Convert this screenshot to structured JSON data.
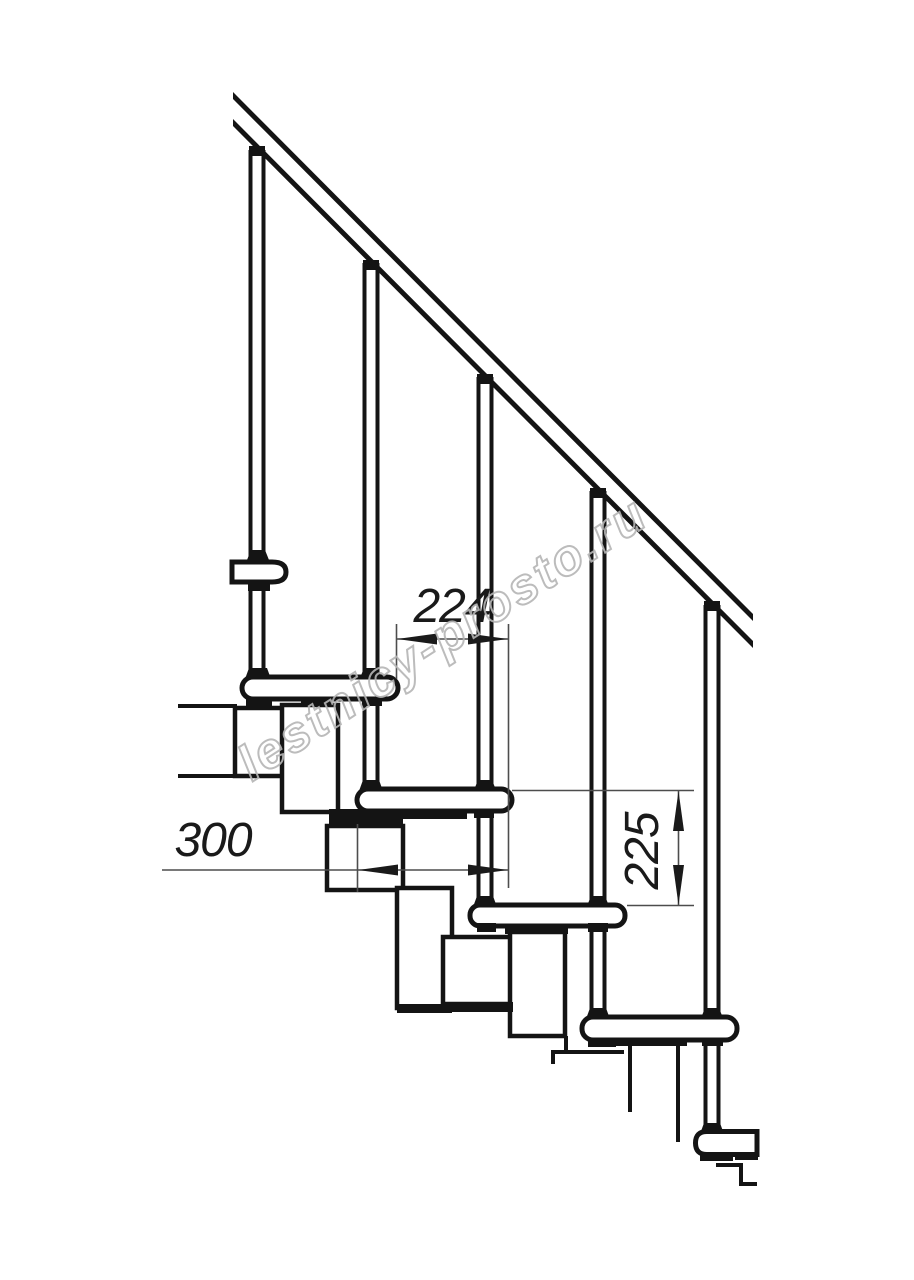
{
  "drawing": {
    "watermark": {
      "text": "lestnicy-prosto.ru",
      "color": "#b5b5b5"
    },
    "dimensions": {
      "step_run": {
        "value": "224",
        "orientation": "horizontal"
      },
      "tread_depth": {
        "value": "300",
        "orientation": "horizontal"
      },
      "step_rise": {
        "value": "225",
        "orientation": "vertical"
      }
    },
    "colors": {
      "ink": "#141414",
      "dimension_line": "#4d4d4d",
      "background": "#ffffff"
    },
    "structure": {
      "balusters": 5,
      "treads": 5
    }
  }
}
